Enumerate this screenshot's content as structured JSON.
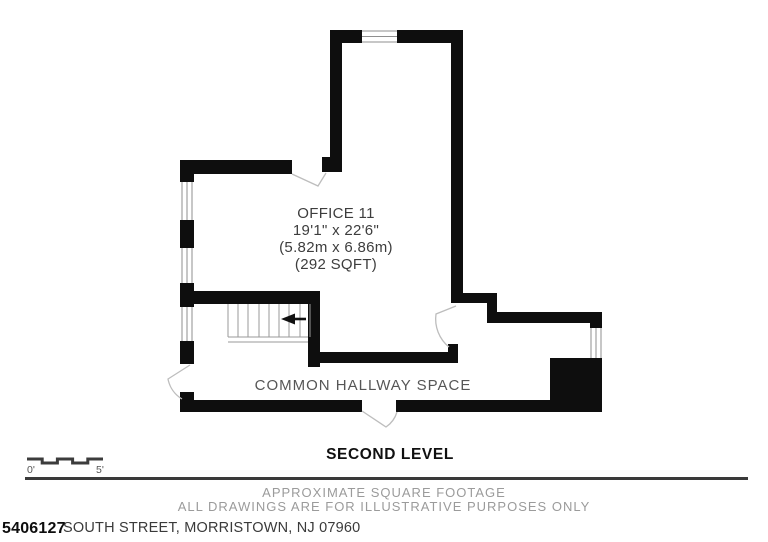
{
  "plan": {
    "office_label": {
      "lines": [
        "OFFICE 11",
        "19'1\" x 22'6\"",
        "(5.82m x 6.86m)",
        "(292 SQFT)"
      ]
    },
    "hallway_label": "COMMON HALLWAY SPACE",
    "level_label": "SECOND LEVEL"
  },
  "scale_bar": {
    "start_label": "0'",
    "end_label": "5'"
  },
  "footer": {
    "line1": "APPROXIMATE SQUARE FOOTAGE",
    "line2": "ALL DRAWINGS ARE FOR ILLUSTRATIVE PURPOSES ONLY",
    "listing_number": "5406127",
    "address": "SOUTH STREET, MORRISTOWN, NJ 07960"
  },
  "colors": {
    "wall": "#0e0e0e",
    "door_swing": "#bdbdbd",
    "label_dark": "#3d3d3d",
    "label_gray": "#565656",
    "footer_gray": "#9b9b9b",
    "background": "#ffffff"
  }
}
